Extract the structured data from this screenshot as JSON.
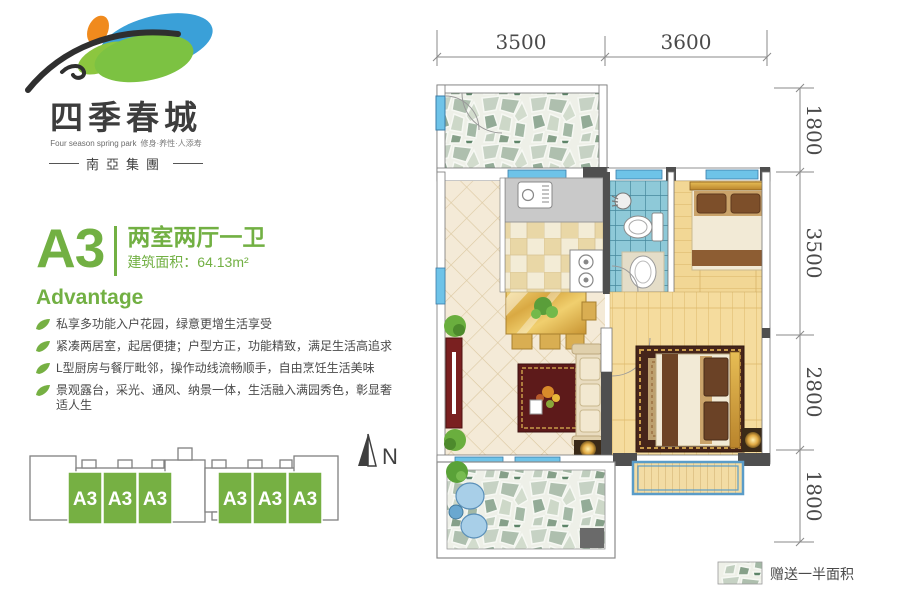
{
  "brand": {
    "name_cn": "四季春城",
    "name_en": "Four season spring park",
    "tagline": "修身·养性·人添寿",
    "group": "南亞集團"
  },
  "unit": {
    "code": "A3",
    "layout": "两室两厅一卫",
    "area": "建筑面积：64.13m²"
  },
  "advantage": {
    "heading": "Advantage",
    "items": [
      "私享多功能入户花园，绿意更增生活享受",
      "紧凑两居室，起居便捷；户型方正，功能精致，满足生活高追求",
      "L型厨房与餐厅毗邻，操作动线流畅顺手，自由烹饪生活美味",
      "景观露台，采光、通风、纳景一体，生活融入满园秀色，彰显奢适人生"
    ]
  },
  "keyplan": {
    "blocks": [
      "A3",
      "A3",
      "A3",
      "A3",
      "A3",
      "A3"
    ]
  },
  "compass": {
    "label": "N"
  },
  "floorplan": {
    "dimensions_top": [
      "3500",
      "3600"
    ],
    "dimensions_right": [
      "1800",
      "3500",
      "2800",
      "1800"
    ],
    "legend": "赠送一半面积"
  },
  "colors": {
    "accent_green": "#72b043",
    "block_green": "#76b043",
    "window_blue": "#6ec3e8",
    "bath_tile": "#8ec9d8",
    "wall_dark": "#4f4f4f",
    "dim_text": "#4a4a4a",
    "carpet_maroon": "#46251a",
    "leaf_blue": "#3aa0d8",
    "leaf_orange": "#f08a1d"
  }
}
